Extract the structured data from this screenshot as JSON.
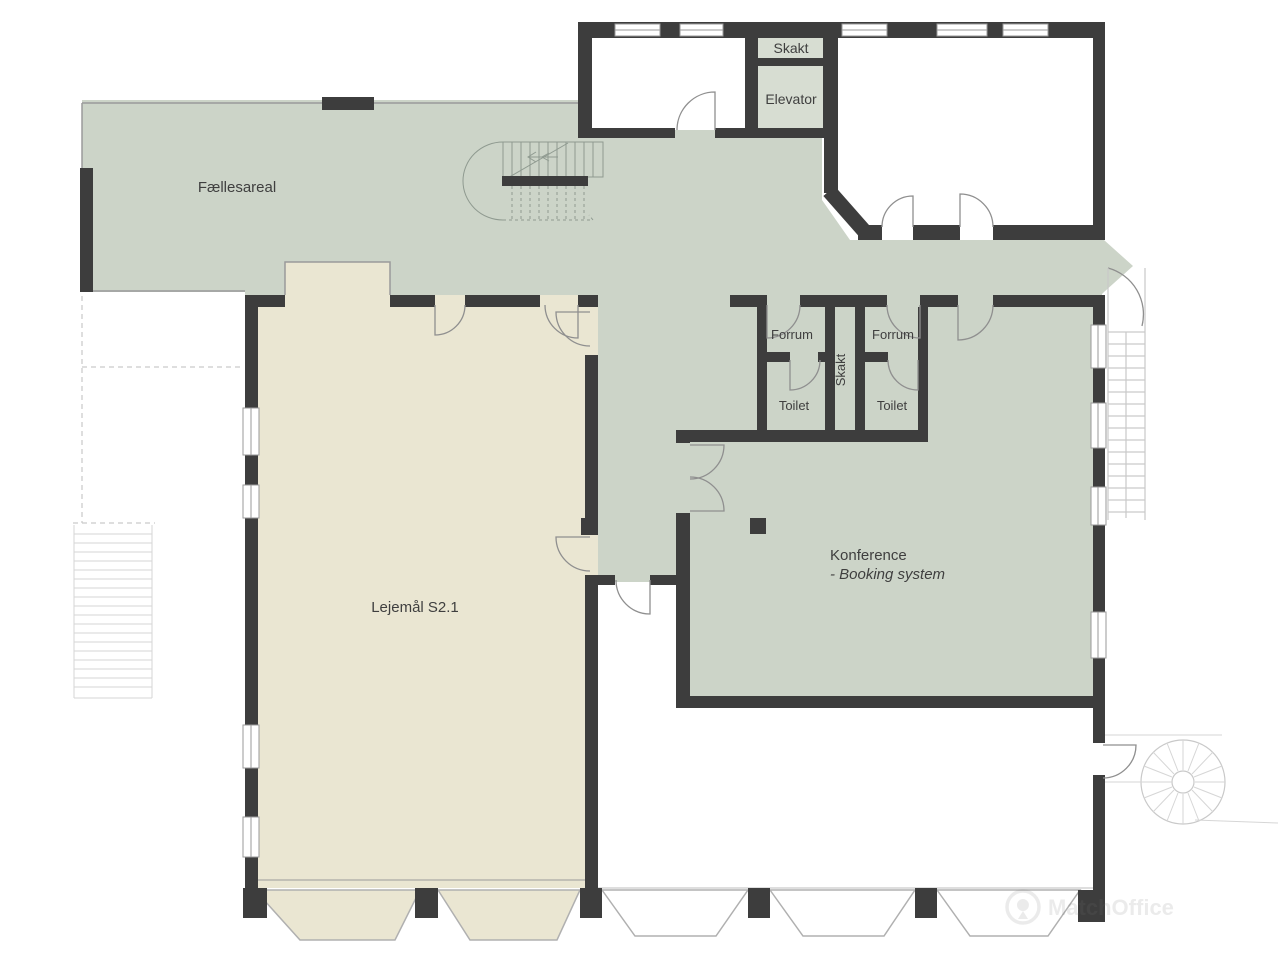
{
  "plan": {
    "title": "Floor plan",
    "rooms": {
      "faellesareal": {
        "label": "Fællesareal"
      },
      "skakt_top": {
        "label": "Skakt"
      },
      "elevator": {
        "label": "Elevator"
      },
      "forrum_left": {
        "label": "Forrum"
      },
      "forrum_right": {
        "label": "Forrum"
      },
      "skakt_mid": {
        "label": "Skakt"
      },
      "toilet_left": {
        "label": "Toilet"
      },
      "toilet_right": {
        "label": "Toilet"
      },
      "lejemaal": {
        "label": "Lejemål S2.1"
      },
      "konference": {
        "label": "Konference",
        "sublabel": "- Booking system"
      }
    },
    "watermark": "MatchOffice",
    "colors": {
      "wall": "#3d3d3d",
      "common_area_green": "#ccd4c8",
      "shaft_room_green": "#d7ddd2",
      "tenancy_beige": "#eae6d2",
      "outline_grey": "#9a9a9a",
      "exterior_faint_grey": "#c9c9c9",
      "label_text": "#3f3f3f"
    }
  }
}
